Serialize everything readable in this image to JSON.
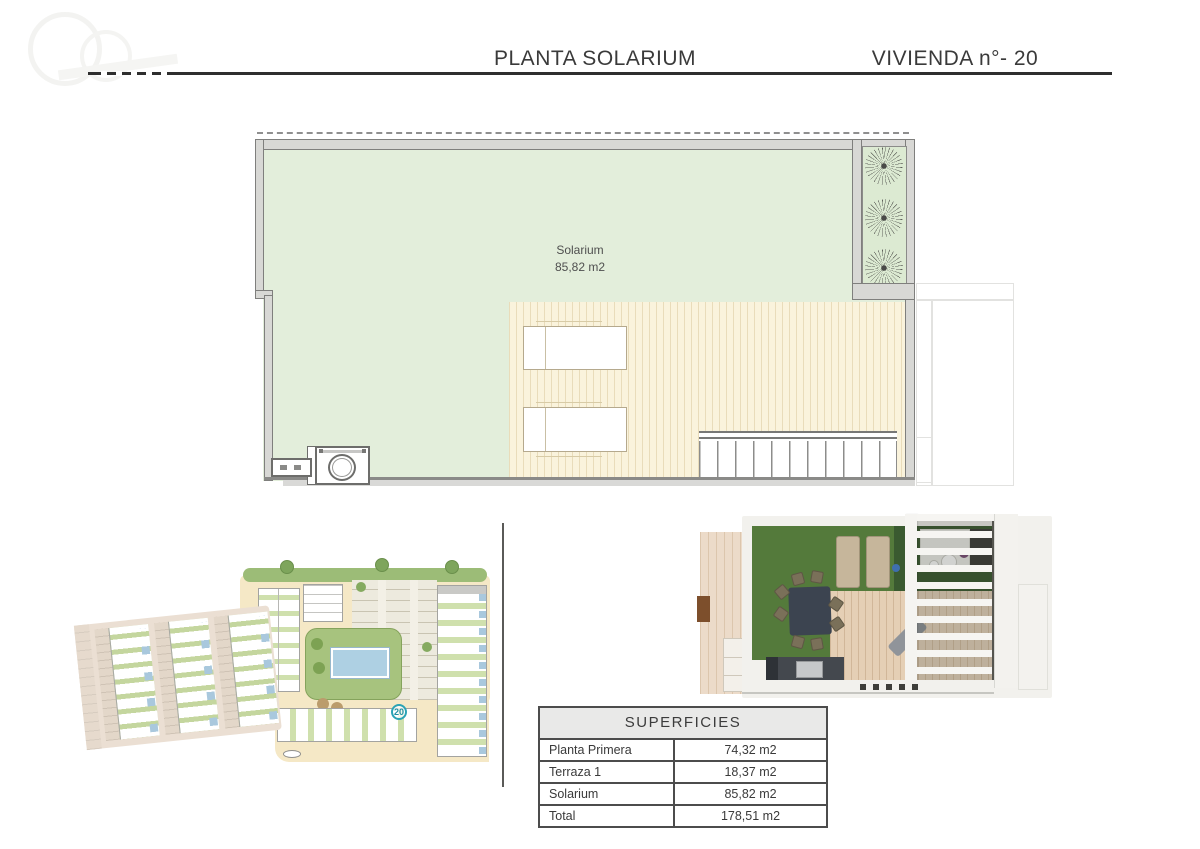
{
  "header": {
    "title": "PLANTA SOLARIUM",
    "unit": "VIVIENDA n°- 20"
  },
  "floor_plan": {
    "room_label": "Solarium",
    "room_area": "85,82 m2"
  },
  "site_plan": {
    "unit_badge": "20"
  },
  "surfaces_table": {
    "title": "SUPERFICIES",
    "rows": [
      {
        "label": "Planta Primera",
        "value": "74,32 m2"
      },
      {
        "label": "Terraza 1",
        "value": "18,37 m2"
      },
      {
        "label": "Solarium",
        "value": "85,82 m2"
      },
      {
        "label": "Total",
        "value": "178,51 m2"
      }
    ]
  },
  "colors": {
    "solarium_green": "#e3eedb",
    "planter_green": "#dcead2",
    "pergola_cream": "#faf3dc",
    "wall_gray": "#d8d8d5",
    "grass_green": "#547a3b",
    "pool_blue": "#aed0e3",
    "site_beige": "#f5e8c6",
    "badge_teal": "#2ba3b5"
  }
}
